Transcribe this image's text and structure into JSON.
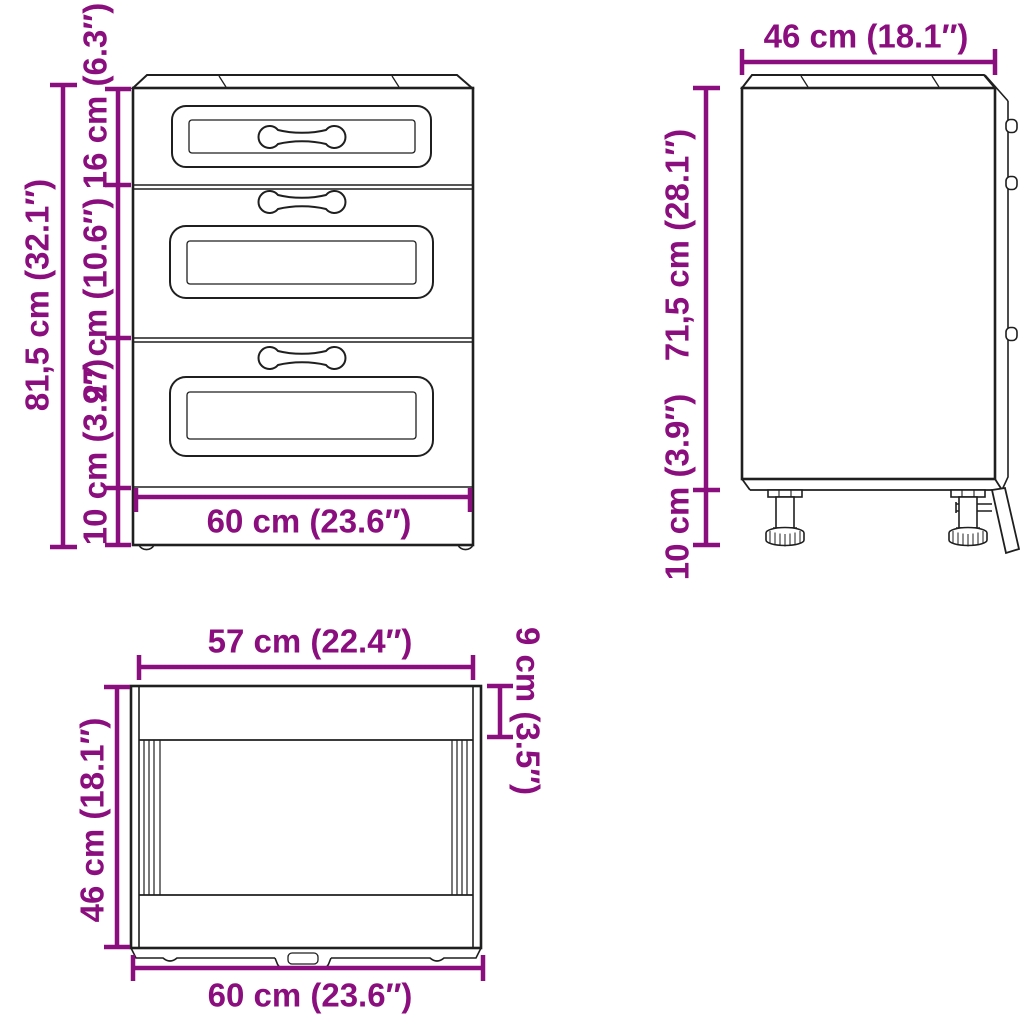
{
  "colors": {
    "dimension": "#8B0E7E",
    "line": "#1F1F1F",
    "background": "#FFFFFF"
  },
  "views": {
    "front": {
      "dims": {
        "overall_height": "81,5 cm (32.1″)",
        "top_drawer_height": "16 cm (6.3″)",
        "middle_drawer_height": "27 cm (10.6″)",
        "plinth_height": "10 cm (3.9″)",
        "width": "60 cm (23.6″)"
      }
    },
    "side": {
      "dims": {
        "depth": "46 cm (18.1″)",
        "body_height": "71,5 cm (28.1″)",
        "leg_height": "10 cm (3.9″)"
      }
    },
    "top": {
      "dims": {
        "inner_width": "57 cm (22.4″)",
        "back_panel_depth": "9 cm (3.5″)",
        "depth": "46 cm (18.1″)",
        "width": "60 cm (23.6″)"
      }
    }
  }
}
